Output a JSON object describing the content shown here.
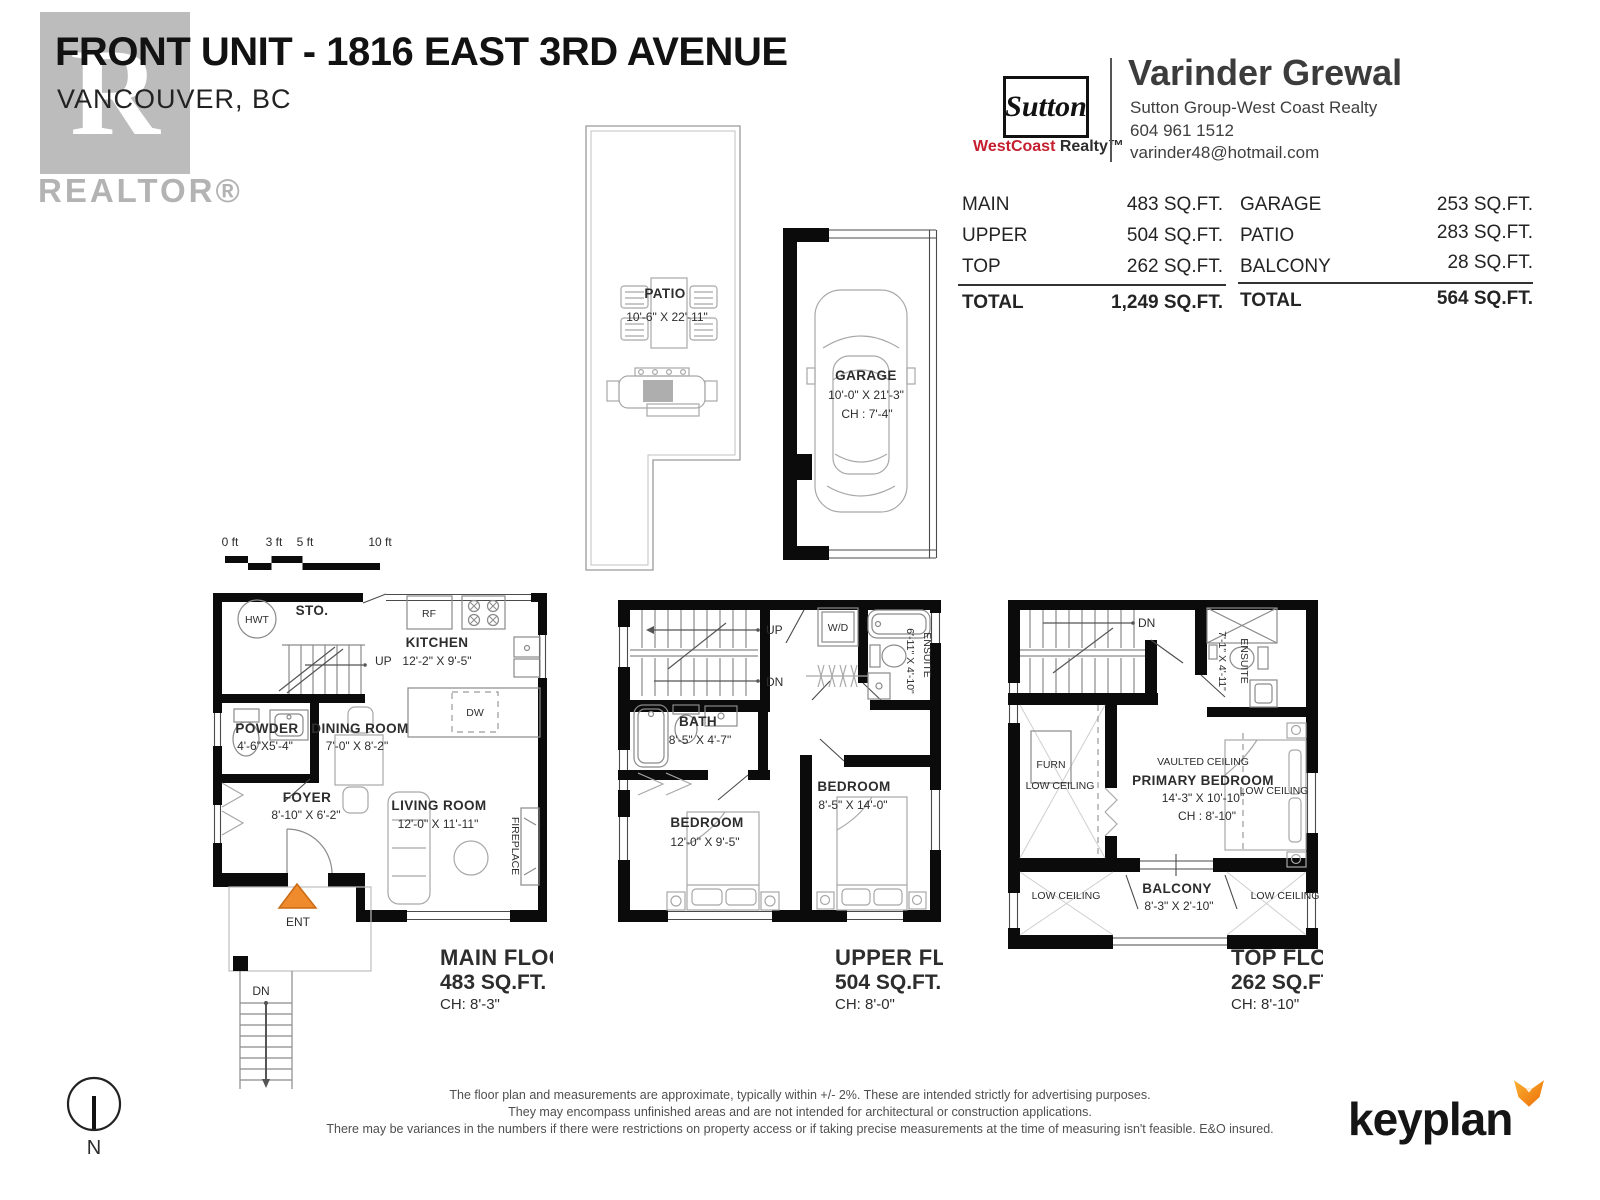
{
  "header": {
    "title": "FRONT UNIT - 1816 EAST 3RD AVENUE",
    "subtitle": "VANCOUVER, BC",
    "realtor_r": "R",
    "realtor_label": "REALTOR®"
  },
  "brand": {
    "sutton": "Sutton",
    "westcoast": "WestCoast",
    "realty": " Realty™"
  },
  "agent": {
    "name": "Varinder Grewal",
    "company": "Sutton Group-West Coast Realty",
    "phone": "604 961 1512",
    "email": "varinder48@hotmail.com"
  },
  "areas": {
    "col1": {
      "rows": [
        {
          "label": "MAIN",
          "value": "483 SQ.FT."
        },
        {
          "label": "UPPER",
          "value": "504 SQ.FT."
        },
        {
          "label": "TOP",
          "value": "262 SQ.FT."
        }
      ],
      "total_label": "TOTAL",
      "total_value": "1,249 SQ.FT."
    },
    "col2": {
      "rows": [
        {
          "label": "GARAGE",
          "value": "253 SQ.FT."
        },
        {
          "label": "PATIO",
          "value": "283 SQ.FT."
        },
        {
          "label": "BALCONY",
          "value": "28 SQ.FT."
        }
      ],
      "total_label": "TOTAL",
      "total_value": "564 SQ.FT."
    }
  },
  "outdoor": {
    "patio": {
      "name": "PATIO",
      "dims": "10'-6\" X 22'-11\""
    },
    "garage": {
      "name": "GARAGE",
      "dims": "10'-0\" X 21'-3\"",
      "ch": "CH : 7'-4\""
    }
  },
  "scalebar": {
    "l0": "0 ft",
    "l3": "3 ft",
    "l5": "5 ft",
    "l10": "10 ft"
  },
  "floors": {
    "main": {
      "title": "MAIN FLOOR",
      "area": "483 SQ.FT.",
      "ch": "CH: 8'-3\"",
      "sto": "STO.",
      "hwt": "HWT",
      "up": "UP",
      "dn": "DN",
      "ent": "ENT",
      "rf": "RF",
      "dw": "DW",
      "fireplace": "FIREPLACE",
      "kitchen": "KITCHEN",
      "kitchen_dims": "12'-2\" X 9'-5\"",
      "powder": "POWDER",
      "powder_dims": "4'-6\"X5'-4\"",
      "dining": "DINING ROOM",
      "dining_dims": "7'-0\" X 8'-2\"",
      "foyer": "FOYER",
      "foyer_dims": "8'-10\" X 6'-2\"",
      "living": "LIVING ROOM",
      "living_dims": "12'-0\" X 11'-11\""
    },
    "upper": {
      "title": "UPPER FLOOR",
      "area": "504 SQ.FT.",
      "ch": "CH: 8'-0\"",
      "up": "UP",
      "dn": "DN",
      "wd": "W/D",
      "ensuite": "ENSUITE",
      "ensuite_dims": "6'-11\" X 4'-10\"",
      "bath": "BATH",
      "bath_dims": "8'-5\" X 4'-7\"",
      "bedroom1": "BEDROOM",
      "bedroom1_dims": "12'-0\" X 9'-5\"",
      "bedroom2": "BEDROOM",
      "bedroom2_dims": "8'-5\" X 14'-0\""
    },
    "top": {
      "title": "TOP FLOOR",
      "area": "262 SQ.FT.",
      "ch": "CH: 8'-10\"",
      "dn": "DN",
      "furn": "FURN",
      "ensuite": "ENSUITE",
      "ensuite_dims": "7'-1\" X 4'-11\"",
      "vaulted": "VAULTED CEILING",
      "primary": "PRIMARY BEDROOM",
      "primary_dims": "14'-3\" X 10'-10\"",
      "primary_ch": "CH : 8'-10\"",
      "low_ceiling": "LOW CEILING",
      "balcony": "BALCONY",
      "balcony_dims": "8'-3\" X 2'-10\""
    }
  },
  "footer": {
    "disclaimer1": "The floor plan and measurements are approximate, typically within +/- 2%. These are intended strictly for advertising purposes.",
    "disclaimer2": "They may encompass unfinished areas and are not intended for architectural or construction applications.",
    "disclaimer3": "There may be variances in the numbers if there were restrictions on property access or if taking precise measurements at the time of measuring isn't feasible. E&O insured.",
    "keyplan": "keyplan",
    "north": "N"
  },
  "colors": {
    "wall": "#0b0b0b",
    "accent_orange": "#ef8b2d",
    "sutton_red": "#c41e2f",
    "logo_gray": "#bcbcbc"
  }
}
